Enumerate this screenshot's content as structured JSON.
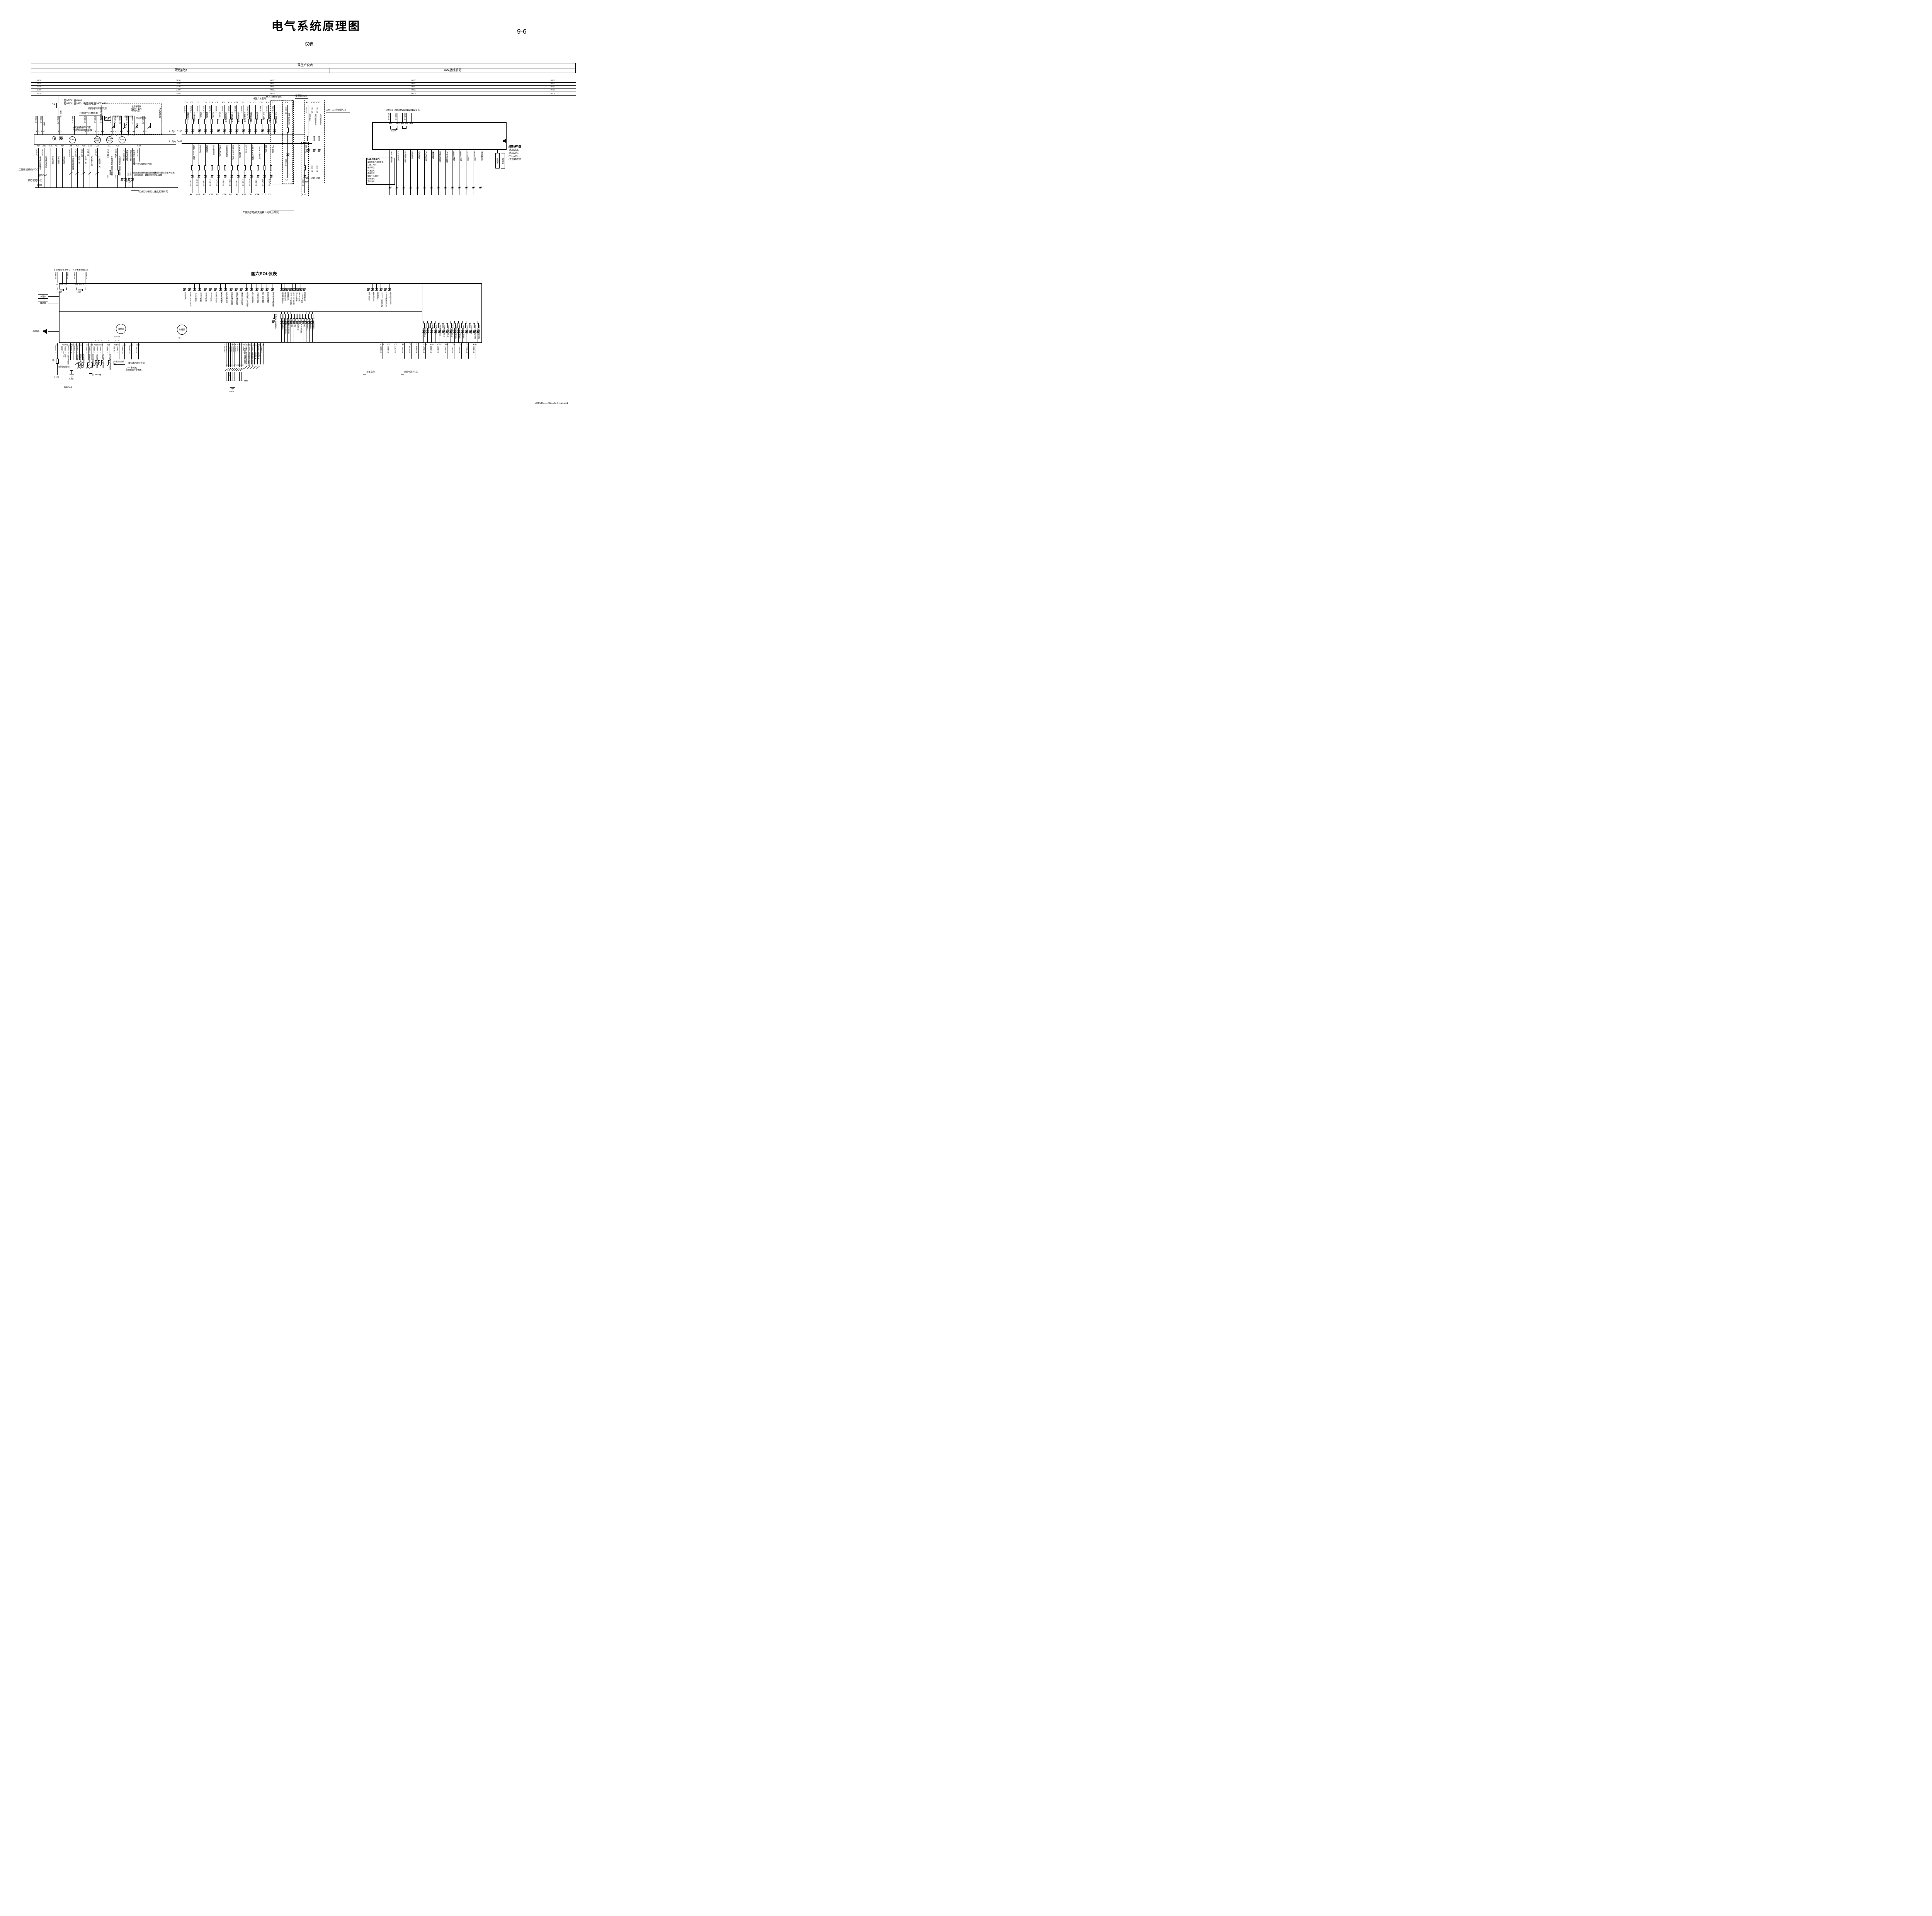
{
  "page": {
    "title": "电气系统原理图",
    "subtitle": "仪表",
    "page_no": "9-6",
    "doc_no": "3700001—91126, H191011"
  },
  "header": {
    "top": "现生产仪表",
    "left": "硬线部分",
    "right": "CAN总线部分"
  },
  "bus": {
    "labels": [
      "0250",
      "0290",
      "0270",
      "0260",
      "0208"
    ]
  },
  "fuse": {
    "rating": "5A",
    "wire": "0401 1.0",
    "note1": "无VECU:接0401",
    "note2": "有VECU:接VECU电源继电器0407/6801"
  },
  "left_block": {
    "esc_note": "(仅康机配ESC用)\n驱动制动灯继电器",
    "loop3": "三回路气压显示用",
    "loop4": "四回路气压显示用",
    "sensor_box": {
      "speed": "车速里程传感器",
      "front": "前回路气压",
      "rear": "后回路气压",
      "park": "驻挂回路气压",
      "water": "水位传感器\n(国六车型用)\n/系统气压",
      "water2": "水位传感器"
    },
    "cluster_label": "仪  表",
    "top_pins": [
      {
        "p": "A15",
        "m": ""
      },
      {
        "p": "A18",
        "m": ""
      },
      {
        "p": "A33",
        "m": ""
      },
      {
        "p": "C13",
        "m": ""
      },
      {
        "p": "A25",
        "m": ""
      },
      {
        "p": "A35",
        "m": "+"
      },
      {
        "p": "A14",
        "m": "S"
      },
      {
        "p": "A11",
        "m": "S"
      },
      {
        "p": "C27",
        "m": "+"
      },
      {
        "p": "A12",
        "m": "S"
      },
      {
        "p": "A26",
        "m": "S"
      },
      {
        "p": "A3",
        "m": "S"
      },
      {
        "p": "A25",
        "m": ""
      }
    ],
    "top_wires": [
      "0401 0.5",
      "0291 0.5",
      "0501 0.75",
      "1411 0.5",
      "1413 0.5",
      "1419 0.5",
      "1420 0.5",
      "1422 0.5",
      "1423 0.5",
      "1445 0.75",
      "1429 0.5",
      "1445 0.75",
      "1412 0.75"
    ],
    "changdian": "常电",
    "gauges": [
      "车速表",
      "前后回路气压表",
      "驻车回路气压表",
      "油量表"
    ],
    "bottom_pins": [
      "A14",
      "A32",
      "A16",
      "A17",
      "A34",
      "A8",
      "A27",
      "A19",
      "C28",
      "C16",
      "A1",
      "A28"
    ],
    "below_cols": [
      {
        "wire": "1409 0.5",
        "label": "车速传感器信号"
      },
      {
        "wire": "1431 0.5",
        "label": "车速信号输出"
      },
      {
        "wire": "",
        "label": "仪表电源-"
      },
      {
        "wire": "",
        "label": "仪表电源-"
      },
      {
        "wire": "",
        "label": "仪表电源-"
      },
      {
        "wire": "1418 0.75",
        "label": "空滤阻塞传感器"
      },
      {
        "wire": "1541 0.75",
        "label": "高档开关"
      },
      {
        "wire": "1542 0.75",
        "label": "低档开关"
      },
      {
        "wire": "1415 0.5",
        "label": "安全带开关"
      },
      {
        "wire": "1408 0.5",
        "label": "驻车制动开关"
      },
      {
        "wire": "1425 0.5",
        "label": "左制动蹄片磨损传感器",
        "tag": "14A0",
        "tag2": "14A1"
      },
      {
        "wire": "1426 0.5",
        "label": "右制动蹄片磨损传感器",
        "tag": "14B0",
        "tag2": "14B1"
      }
    ],
    "alarm_cols": [
      {
        "label": "气压过低报警"
      },
      {
        "label": "水位过低报警"
      },
      {
        "label": "油量过低报警"
      },
      {
        "label": "制动蹄片磨损报警"
      }
    ],
    "c19": {
      "pin": "C19",
      "wire": "14A0 0.5",
      "note": "接行驶记录仪(中文)"
    },
    "notes": {
      "vdo": "接行驶记录仪(VDO)",
      "ecas": "接ECAS",
      "tacho": "接行驶记录仪",
      "rail": "0100",
      "only_vecu": "仅VECU/EECU无此接线时用",
      "serial": "左右两侧的制动蹄片磨损传感器分别串联后接入仪表,\n线号分别以14AX、14BX依次往后编排"
    }
  },
  "row1": {
    "rail_label": "A17(-)",
    "rail_wire": "0100",
    "note_non_g6": "非国六车型用",
    "cols": [
      {
        "pin": "C26",
        "wire": "1103 0.5",
        "label": "仪表照明"
      },
      {
        "pin": "C2",
        "wire": "0717 0.5",
        "label": "干燥器指示"
      },
      {
        "pin": "C3",
        "wire": "1202 0.5",
        "label": "后雾灯"
      },
      {
        "pin": "C10",
        "wire": "1201 0.5",
        "label": "前雾灯"
      },
      {
        "pin": "C14",
        "wire": "1007 0.5",
        "label": "近光灯"
      },
      {
        "pin": "C9",
        "wire": "1003 0.5",
        "label": "远光灯"
      },
      {
        "pin": "A30",
        "wire": "1322 0.5",
        "label": "挂车右转向"
      },
      {
        "pin": "A29",
        "wire": "1306 0.5",
        "label": "主车右转向"
      },
      {
        "pin": "C21",
        "wire": "1321 0.5",
        "label": "挂车左转向"
      },
      {
        "pin": "C22",
        "wire": "1305 0.5",
        "label": "主车左转向"
      },
      {
        "pin": "C18",
        "wire": "0305/0308/0310",
        "label": "浮动桥报警"
      },
      {
        "pin": "C1",
        "wire": "",
        "label": "燃油预热"
      },
      {
        "pin": "C25",
        "wire": "4371 0.5",
        "label": "空气悬架"
      },
      {
        "pin": "A36",
        "wire": "2002 0.5",
        "label": "后视镜加热"
      },
      {
        "pin": "C7",
        "wire": "0302 0.5",
        "label": "进气预热指示"
      }
    ],
    "c4": {
      "pin": "C4",
      "wire": "0553 0.5",
      "label": "排气制动指示",
      "wire2": "0554 0.5",
      "pin2": "C7"
    }
  },
  "row2": {
    "rail_label": "A18(+)",
    "rail_wire": "0401",
    "pto_note": "工作指示用(接变速箱上的取力开关)",
    "cols": [
      {
        "label": "挂车ABS指示",
        "wire": "1783 0.5",
        "pin": "A4"
      },
      {
        "label": "低档指示",
        "wire": "1542 0.5",
        "pin": "A19"
      },
      {
        "label": "高档指示",
        "wire": "1541 0.5",
        "pin": "A27"
      },
      {
        "label": "安全带指示",
        "wire": "1415 0.5",
        "pin": "C28"
      },
      {
        "label": "空滤阻塞指示",
        "wire": "1418 0.5",
        "pin": "A8"
      },
      {
        "label": "驻车制动指示",
        "wire": "1408 0.5",
        "pin": "C16"
      },
      {
        "label": "主车ABS指示",
        "wire": "1704 0.5",
        "pin": "A6"
      },
      {
        "label": "ASR指示灯",
        "wire": "1706 0.5",
        "pin": "A9"
      },
      {
        "label": "灯丝检测",
        "wire": "1416 0.5",
        "pin": "C12"
      },
      {
        "label": "ECAS失效灯",
        "wire": "4356 0.5",
        "pin": "C6"
      },
      {
        "label": "ECAS警告灯",
        "wire": "4355 0.5",
        "pin": "C24"
      },
      {
        "label": "充电指示",
        "wire": "0205 0.5",
        "pin": "C17"
      },
      {
        "label": "门开报警",
        "wire": "0724 0.5",
        "pin": "C5"
      },
      {
        "label": "取力指示",
        "wire": "1503 0.5",
        "pin": "A10"
      }
    ]
  },
  "pto": {
    "note_engine": "按发动机原理接",
    "note_on": "接通指示用",
    "note_c20": "C20、C23接仪表A18",
    "cols": [
      {
        "pin": "A7",
        "wire": "1503 0.5",
        "label": "取力指示",
        "wire2": "",
        "bottom": "A10",
        "bottom2": "(接地)"
      },
      {
        "pin": "C20",
        "wire": "0401 0.5",
        "label": "轴间差速指示",
        "wire2": "1521 0.5",
        "bottom": "C15",
        "bottom2": ""
      },
      {
        "pin": "C23",
        "wire": "0401 0.5",
        "label": "轮间差速指示",
        "wire2": "1531 0.5",
        "bottom": "C11",
        "bottom2": ""
      }
    ]
  },
  "can": {
    "labels": [
      "CAN-H",
      "CAN-M",
      "CAN-L-1",
      "CAN-L-2",
      "CAN-SHD"
    ],
    "wires": [
      "0014 0.5",
      "0020 0.5",
      "0015 0.5"
    ],
    "pins": [
      "A21",
      "A23",
      "A22",
      "A5",
      "A24"
    ],
    "res": "120Ω",
    "buzzer_title": "报警蜂鸣器",
    "buzzer_items": [
      "-水温过高",
      "-水位过低",
      "-气压过低",
      "-变速箱故障"
    ],
    "lcd_title": "LCD点阵显示:",
    "lcd_items": [
      "发动机电控系统故障",
      "日期、时间",
      "尿素液位",
      "机油压力",
      "电瓶电压",
      "里程小计/累计",
      "小计油耗",
      "累计油耗"
    ],
    "indicators": [
      "水温过高报警",
      "PTO激活",
      "机油压力报警",
      "巡航指示",
      "停机报警",
      "发动机制动",
      "维护报警",
      "等待起动指示",
      "油中含水报警",
      "EBS报警",
      "EBS失效",
      "MIL指示",
      "ESC指示",
      "缓速器指示"
    ],
    "gauges": [
      "水温表",
      "转速表"
    ]
  },
  "eol": {
    "title": "国六EOL仪表",
    "dcan": {
      "labels": [
        "D-CAN_H",
        "D-CAN_M",
        "D-CAN-L"
      ],
      "w1": "0024 0.5",
      "w2": "0025 0.5",
      "pins": [
        "A5",
        "A9",
        "A6"
      ],
      "res": "120Ω"
    },
    "pcan": {
      "labels": [
        "P-CAN_H",
        "P-CAN_M",
        "P-CAN-L"
      ],
      "w1": "0014 0.5",
      "w2": "0015 0.5",
      "pins": [
        "A21",
        "A23",
        "A22"
      ],
      "res": "120Ω"
    },
    "left_gauges": [
      "水温表",
      "转速表"
    ],
    "speaker": "扬声器",
    "tier1a": [
      "灯丝检测",
      "主车ABS指示灯",
      "ASR指示",
      "EBS报警",
      "EBS失效",
      "ESC指示",
      "驻车制动指示",
      "安全气囊报警",
      "维护保养指示",
      "发动机维修报警",
      "发动机维护报警",
      "发动机停机报警",
      "机油压力过低报警",
      "水位过低报警",
      "水温过高报警",
      "油中含水报警",
      "胎压过低报警",
      "变速箱油温高报警"
    ],
    "tier1b": [
      "辅助制动指示灯",
      "发动机制动",
      "缓速器指示",
      "ECAS失效灯",
      "ECAS警告灯",
      "MIL指示",
      "DPF指示",
      "HEST指示",
      "驾驶员警告"
    ],
    "tier1c": [
      "低半档指示",
      "高半档指示",
      "巡航指示",
      "Acc工作指示灯",
      "PTO激活指示灯",
      "等待起动指示灯"
    ],
    "tier2a": [
      "空滤阻塞指示灯",
      "司机侧安全带指示灯",
      "乘客侧安全带指示灯",
      "高档指示灯",
      "低档指示灯",
      "门开报警指示灯",
      "挂车ABS指示灯",
      "充电指示灯",
      "轴间差速指示灯",
      "轮间差速指示灯",
      "灯丝检测指示灯"
    ],
    "tier2b": [
      "仪表照明指示灯",
      "前雾灯",
      "后雾灯",
      "取力指示灯",
      "干燥器指示灯",
      "燃油预热指示灯",
      "进气预热指示灯",
      "空气悬架指示灯",
      "后视镜加热指示灯",
      "主车左转向指示灯",
      "主车右转向指示灯",
      "远光指示灯",
      "近光指示灯",
      "挂车左转向指示灯",
      "挂车右转向指示灯"
    ],
    "mid_note": "制动蹄片磨损指示灯",
    "gauge_fuel": "油量表",
    "gauge_speed": "车速表",
    "term_fuel": "S + S S",
    "term_speed": "+ S -"
  },
  "eolb": {
    "g1": [
      {
        "pin": "A15",
        "wire": "0401 1.0",
        "label": ""
      },
      {
        "pin": "A24",
        "wire": "0291 0.5",
        "label": "常电"
      },
      {
        "pin": "A32",
        "wire": "1431 0.5",
        "label": "车速信号输出"
      },
      {
        "pin": "A16",
        "wire": "0100 0.75",
        "label": ""
      },
      {
        "pin": "A34",
        "wire": "0100 0.75",
        "label": ""
      },
      {
        "pin": "A10",
        "wire": "5290 0.5",
        "label": "空调压力开关"
      },
      {
        "pin": "A17",
        "wire": "5291 0.5",
        "label": "油中含水传感器",
        "wire2": "1445 0.5"
      },
      {
        "pin": "A3",
        "wire": "",
        "label": "水位传感器"
      },
      {
        "pin": "A13",
        "wire": "1417 0.5",
        "label": "油量传感器"
      },
      {
        "pin": "A20",
        "wire": "1424 0.5",
        "label": "环境温度传感器"
      }
    ],
    "g2": [
      {
        "pin": "A11",
        "s": "S",
        "wire": "1419 0.5",
        "label": "前回路气压传感器"
      },
      {
        "pin": "C27",
        "s": "+",
        "wire": "1420 0.5",
        "label": ""
      },
      {
        "pin": "A12",
        "s": "S",
        "wire": "1422 0.5",
        "label": "后回路气压传感器"
      },
      {
        "pin": "A26",
        "s": "S",
        "wire": "1423 0.5",
        "label": "驻车回路气压传感器"
      },
      {
        "pin": "A35",
        "s": "+",
        "wire": "1411 0.5",
        "label": ""
      },
      {
        "pin": "A14",
        "s": "S",
        "wire": "1413 0.5",
        "label": ""
      },
      {
        "pin": "A31",
        "s": "-",
        "wire": "1412 0.75",
        "label": ""
      },
      {
        "pin": "A25",
        "s": "",
        "wire": "0501 0.75",
        "label": ""
      },
      {
        "pin": "C19",
        "s": "",
        "wire": "14A0 0.5",
        "label": ""
      }
    ],
    "g3": [
      {
        "pin": "A1",
        "wire": "4272 0.5",
        "tap": "L1"
      },
      {
        "pin": "C4",
        "wire": "4275 0.5",
        "tap": "L2"
      },
      {
        "pin": "C6",
        "wire": "4278 0.5",
        "tap": "L3"
      },
      {
        "pin": "C8",
        "wire": "4270 0.5",
        "tap": "L4"
      },
      {
        "pin": "A28",
        "wire": "4282 0.5",
        "tap": "R1"
      },
      {
        "pin": "C18",
        "wire": "4285 0.5",
        "tap": "R2"
      },
      {
        "pin": "C20",
        "wire": "4288 0.5",
        "tap": "R3"
      },
      {
        "pin": "C23",
        "wire": "4280 0.5",
        "tap": "R4"
      }
    ],
    "g3_lower_wire": "0. 75",
    "g3_label": "制动蹄片磨损传感器",
    "g3_bus": "0100",
    "g4": [
      {
        "pin": "A8",
        "wire": "1418 0.5",
        "label": "空滤阻塞传感器",
        "wire2": "1415 0.5"
      },
      {
        "pin": "C28",
        "wire": "14B6 0.5",
        "label": "司机侧安全带开关",
        "wire2": ""
      },
      {
        "pin": "C24",
        "wire": "1541 0.75",
        "label": "乘客侧安全带开关",
        "wire2": ""
      },
      {
        "pin": "A27",
        "wire": "1542 0.5",
        "label": "高档开关",
        "wire2": ""
      },
      {
        "pin": "A19",
        "wire": "",
        "label": "低档开关",
        "wire2": ""
      },
      {
        "pin": "C5",
        "wire": "0724 0.5",
        "label": "",
        "wire2": ""
      },
      {
        "pin": "A4",
        "wire": "1783 0.5",
        "label": "",
        "wire2": ""
      }
    ],
    "g5": [
      {
        "pin": "C26",
        "wire": "1103 0.5"
      },
      {
        "pin": "C10",
        "wire": "1201 0.5"
      },
      {
        "pin": "C3",
        "wire": "1202 0.5"
      },
      {
        "pin": "A7",
        "wire": "1503 0.5"
      },
      {
        "pin": "C2",
        "wire": "0717 0.5"
      },
      {
        "pin": "C7",
        "wire": "0302 0.5"
      },
      {
        "pin": "C25",
        "wire": "4371 0.5"
      },
      {
        "pin": "A36",
        "wire": "2002 0.5"
      },
      {
        "pin": "C22",
        "wire": "1305 0.5"
      },
      {
        "pin": "A29",
        "wire": "1306 0.5"
      },
      {
        "pin": "C14",
        "wire": "1007 0.5"
      },
      {
        "pin": "C9",
        "wire": "1003 0.5"
      },
      {
        "pin": "C21",
        "wire": "1321 0.5"
      },
      {
        "pin": "A30",
        "wire": "1322 0.5"
      }
    ],
    "fuse": "5A",
    "fuse_out": "0208",
    "branch_wire": "0401 0.5",
    "notes": {
      "tacho": "接行驶记录仪",
      "ecas": "接ECAS",
      "gnd": "GND",
      "ddi": "仅DDi11用",
      "tacho_cn": "接行驶记录仪(中文)",
      "esc": "(ESC系统用)\n驱动制动灯继电器",
      "speed_box": "车速里程传感器",
      "trailer": "挂车指示",
      "power6": "仪表电源共6路"
    }
  }
}
